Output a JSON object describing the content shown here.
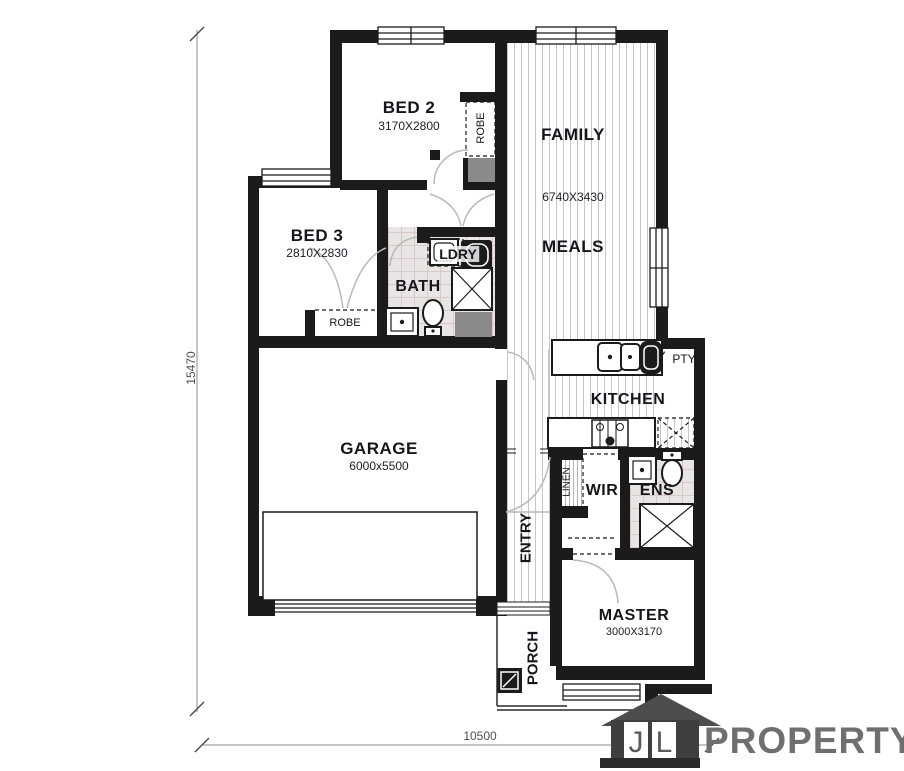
{
  "rooms": {
    "bed2": {
      "label": "BED 2",
      "dims": "3170X2800"
    },
    "bed3": {
      "label": "BED 3",
      "dims": "2810X2830"
    },
    "family": {
      "label": "FAMILY",
      "dims": "6740X3430"
    },
    "meals": {
      "label": "MEALS"
    },
    "kitchen": {
      "label": "KITCHEN"
    },
    "pantry": {
      "label": "PTY"
    },
    "garage": {
      "label": "GARAGE",
      "dims": "6000x5500"
    },
    "entry": {
      "label": "ENTRY"
    },
    "porch": {
      "label": "PORCH"
    },
    "master": {
      "label": "MASTER",
      "dims": "3000X3170"
    },
    "wir": {
      "label": "WIR"
    },
    "ens": {
      "label": "ENS"
    },
    "linen": {
      "label": "LINEN"
    },
    "bath": {
      "label": "BATH"
    },
    "laundry": {
      "label": "LDRY"
    },
    "robe_bed2": {
      "label": "ROBE"
    },
    "robe_bed3": {
      "label": "ROBE"
    }
  },
  "dimensions": {
    "overall_depth": "15470",
    "overall_width": "10500"
  },
  "logo": {
    "letters": [
      "J",
      "L"
    ],
    "wordmark": "PROPERTY"
  },
  "colors": {
    "wall": "#1b1b1b",
    "tile_bg": "#eae5e5",
    "tile_line": "#d9caca",
    "floor_line": "#c6c6c6",
    "gray_fill": "#8a8a8a",
    "dim_line": "#7a7a7a",
    "logo_house": "#474747",
    "logo_text": "#6f6f6f"
  }
}
